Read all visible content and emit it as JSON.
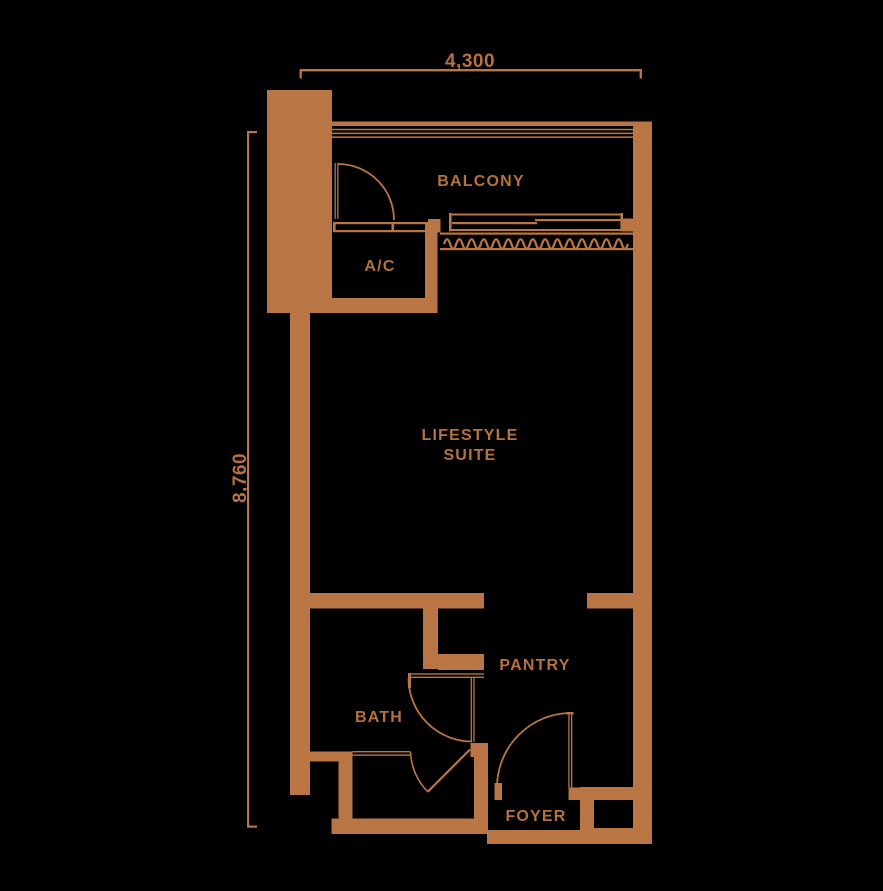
{
  "title": "Lifestyle suite floor plan",
  "colors": {
    "background": "#000000",
    "accent": "#b97544",
    "label": "#b5713e"
  },
  "dimensions": {
    "width_label": "4,300",
    "height_label": "8,760"
  },
  "rooms": {
    "balcony": "BALCONY",
    "ac": "A/C",
    "suite_line1": "LIFESTYLE",
    "suite_line2": "SUITE",
    "pantry": "PANTRY",
    "bath": "BATH",
    "foyer": "FOYER"
  }
}
